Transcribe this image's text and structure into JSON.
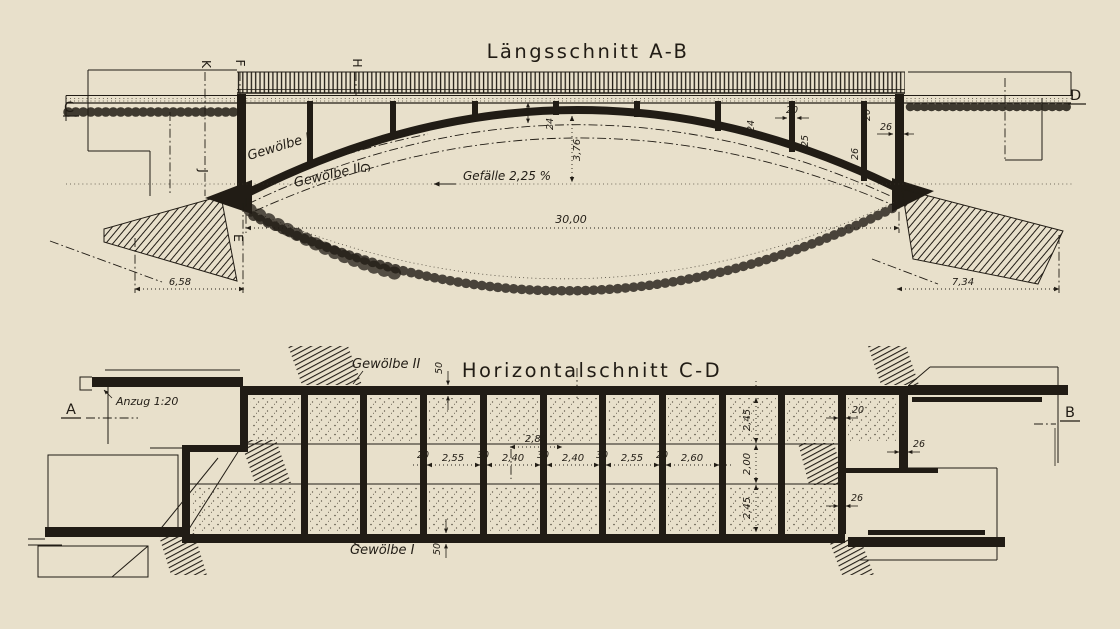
{
  "colors": {
    "paper": "#e8e0cb",
    "ink": "#211c15"
  },
  "laengsschnitt": {
    "title": "Längsschnitt  A-B",
    "gefaelle": "Gefälle  2,25 %",
    "gewoelbe_1": "Gewölbe I",
    "gewoelbe_2": "Gewölbe II",
    "letters": {
      "c": "C",
      "d": "D",
      "k": "K",
      "f": "F",
      "h": "H",
      "j": "J",
      "e": "E",
      "g": "G"
    },
    "dims": {
      "rise": "3,76",
      "span": "30,00",
      "gruendung_links": "6,58",
      "gruendung_rechts": "7,34",
      "crown": "24",
      "arch_1": "24",
      "column": "20",
      "arch_2": "25",
      "deck": "20",
      "endwall": "26",
      "arch_3": "26"
    }
  },
  "horizontalschnitt": {
    "title": "Horizontalschnitt  C-D",
    "anzug": "Anzug 1:20",
    "gewoelbe_1": "Gewölbe I",
    "gewoelbe_2": "Gewölbe II",
    "letters": {
      "a": "A",
      "b": "B"
    },
    "dims": {
      "chain": [
        "20",
        "2,55",
        "30",
        "2,40",
        "30",
        "2,40",
        "30",
        "2,55",
        "20",
        "2,60"
      ],
      "span_mid": "2,80",
      "vchain": [
        "2,45",
        "2,00",
        "2,45"
      ],
      "wall_20": "20",
      "wall_26_right": "26",
      "wall_26_bottom": "26",
      "fifty_top": "50",
      "fifty_bottom": "50"
    }
  }
}
